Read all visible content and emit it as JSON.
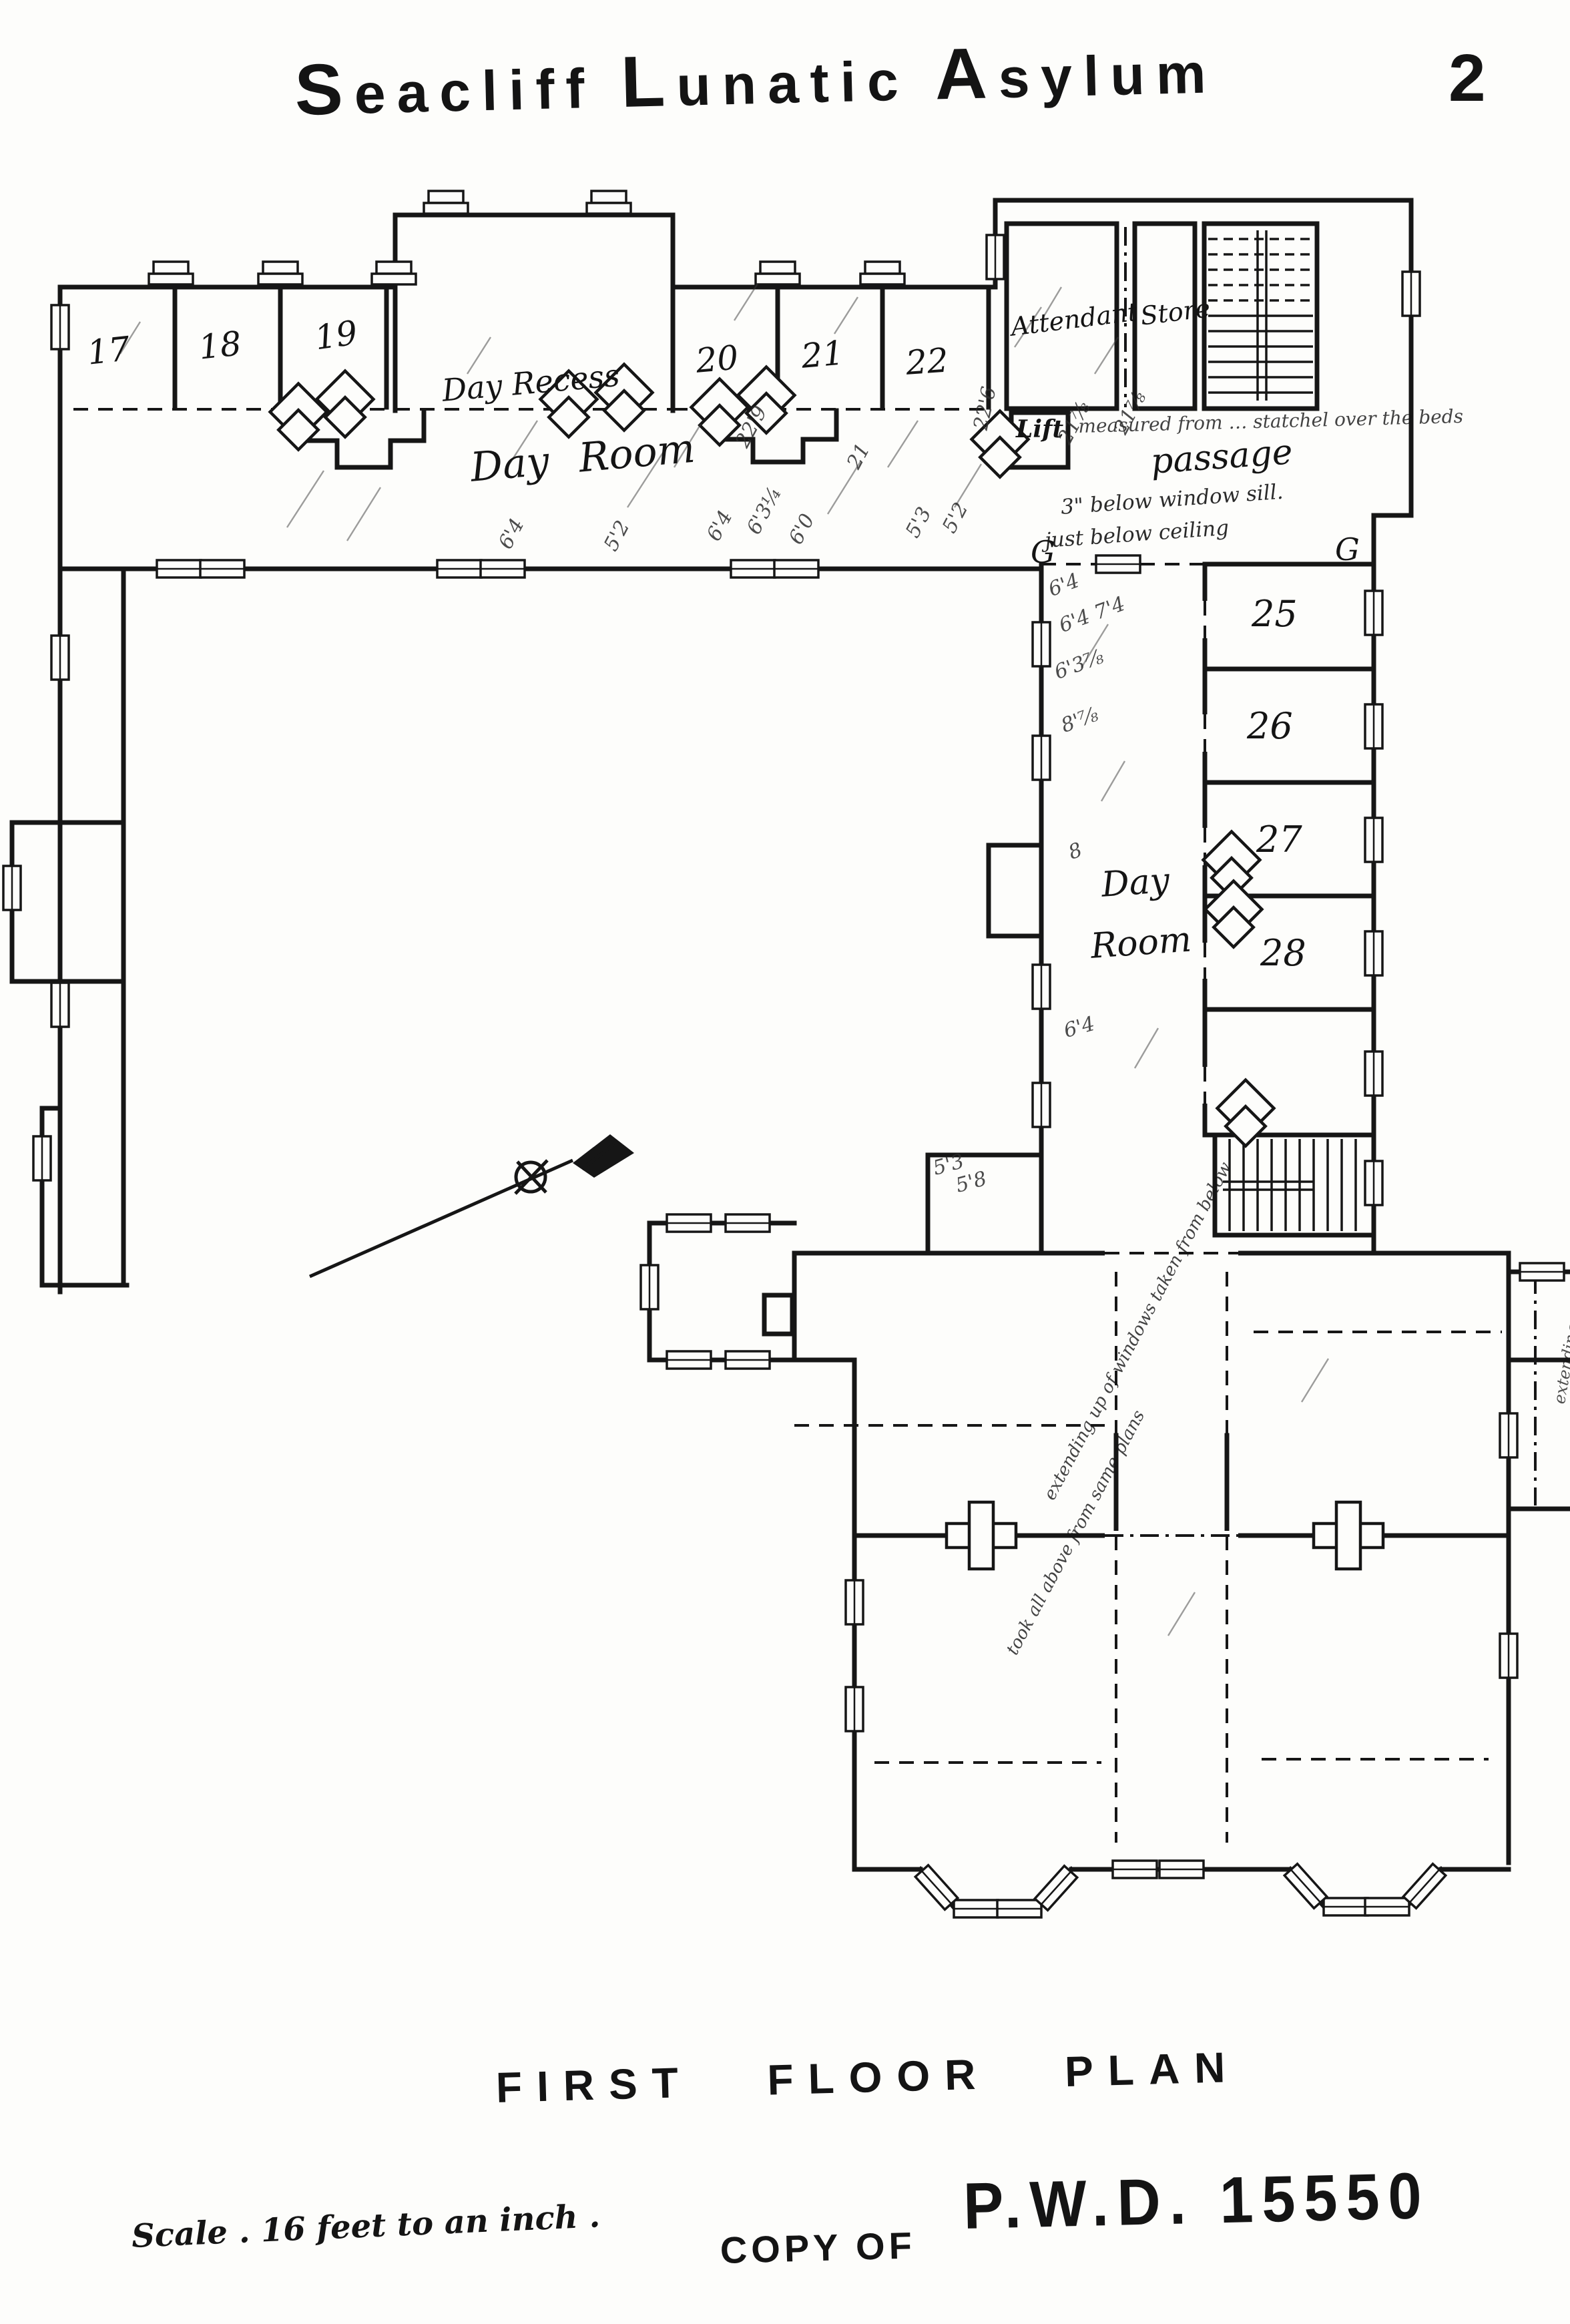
{
  "page": {
    "title_words": [
      "Seacliff",
      "Lunatic",
      "Asylum"
    ],
    "page_number": "2",
    "caption": "FIRST FLOOR PLAN",
    "scale_note": "Scale . 16 feet to an inch .",
    "copy_of": "COPY OF",
    "stamp": "P.W.D.  15550"
  },
  "rooms": {
    "r17": "17",
    "r18": "18",
    "r19": "19",
    "r20": "20",
    "r21": "21",
    "r22": "22",
    "r25": "25",
    "r26": "26",
    "r27": "27",
    "r28": "28",
    "day_recess": "Day Recess",
    "day_room": "Day Room",
    "attendant": "Attendant",
    "store": "Store",
    "lift": "Lift",
    "passage": "passage",
    "wing_day": "Day",
    "wing_room": "Room"
  },
  "notes": {
    "beds": "measured from … statchel over the beds",
    "sill": "3\" below window sill.",
    "ceiling": "just below ceiling",
    "windows_note": "extending up of windows taken from below",
    "plans_note": "took all above from same plans",
    "section_g": "G"
  },
  "measurements": [
    "22'9",
    "21",
    "21⅞",
    "21⅞",
    "22'6",
    "6'4",
    "6'4",
    "6'3¼",
    "6'0",
    "5'3",
    "5'2",
    "6'4 7'4",
    "6'3⅞",
    "8'⅞",
    "8",
    "6'4",
    "5'3",
    "5'8",
    "6'4",
    "5'2"
  ]
}
